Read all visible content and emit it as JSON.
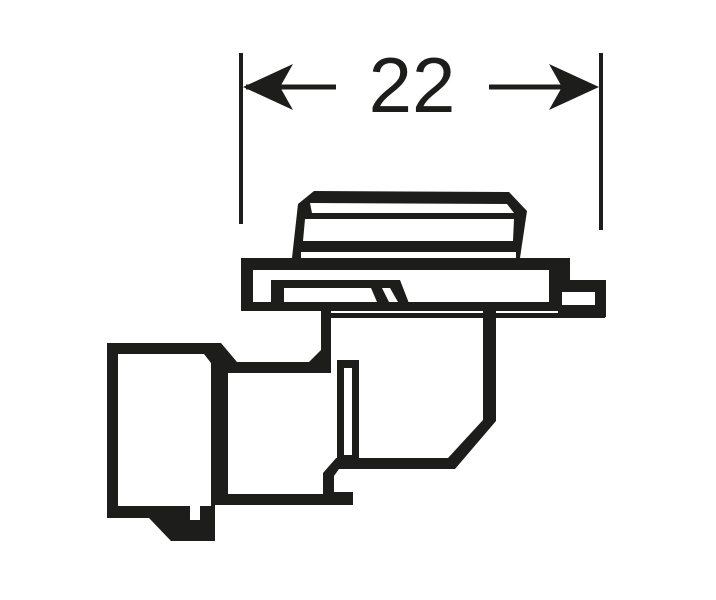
{
  "figure": {
    "dimension": {
      "value": "22"
    },
    "colors": {
      "ink": "#1d1d1b",
      "background": "#ffffff"
    }
  }
}
